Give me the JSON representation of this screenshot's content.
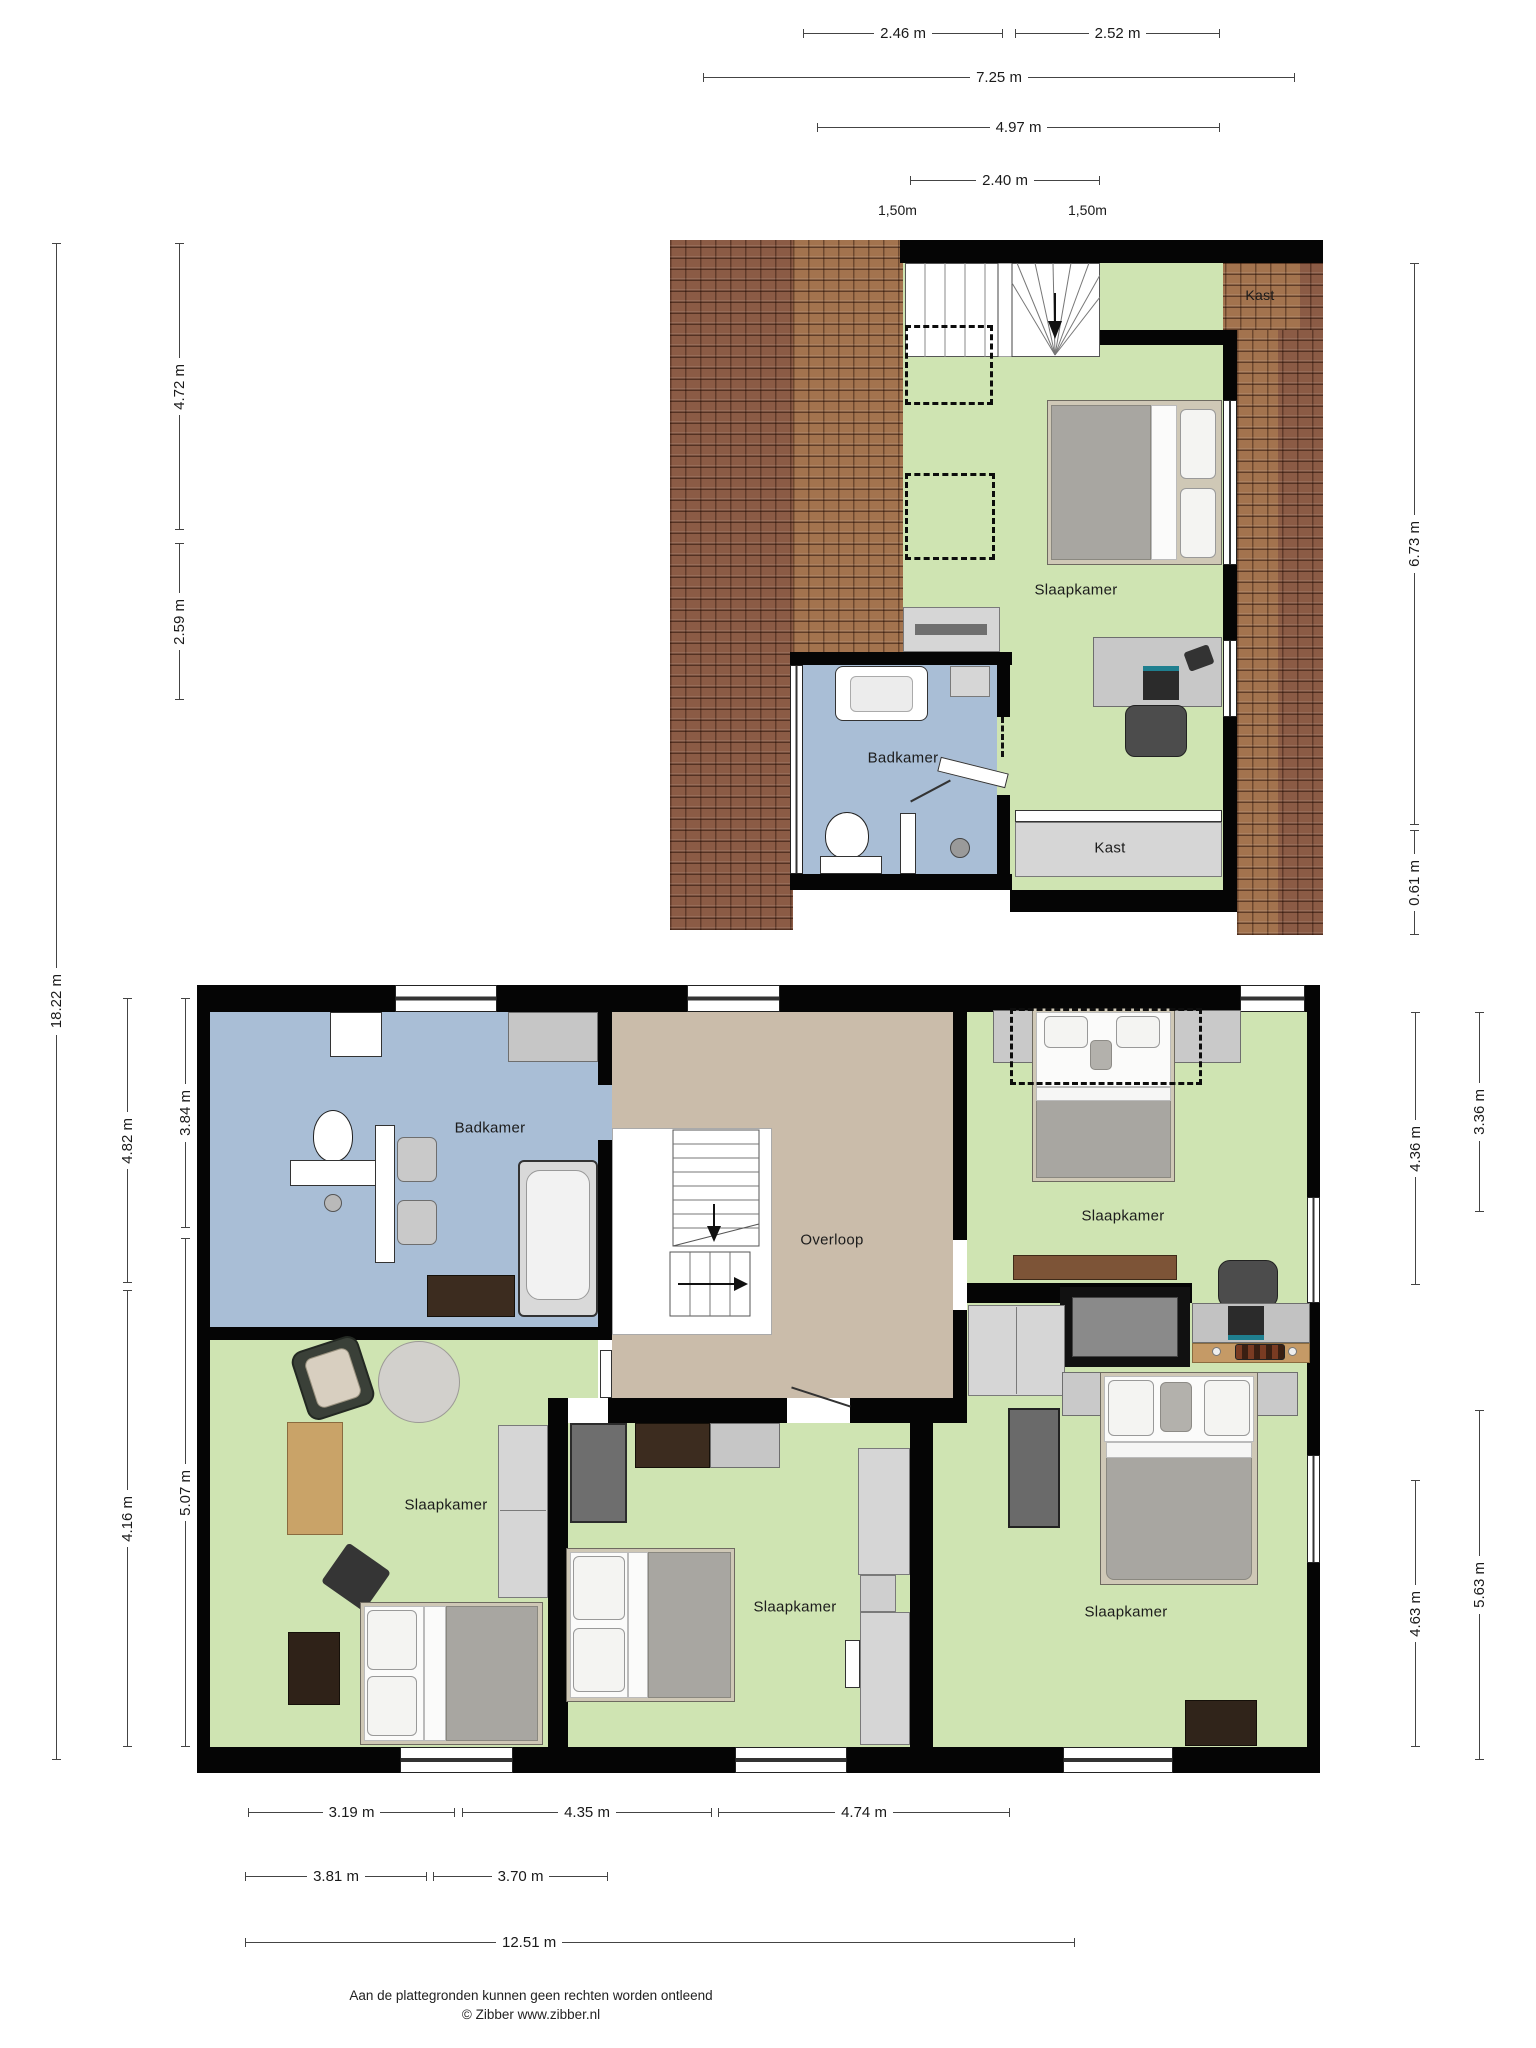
{
  "dims": {
    "w246": "2.46 m",
    "w252": "2.52 m",
    "w725": "7.25 m",
    "w497": "4.97 m",
    "w240": "2.40 m",
    "w150a": "1,50m",
    "w150b": "1,50m",
    "h472": "4.72 m",
    "h259": "2.59 m",
    "h1822": "18.22 m",
    "h673": "6.73 m",
    "h061": "0.61 m",
    "h482": "4.82 m",
    "h384": "3.84 m",
    "h416": "4.16 m",
    "h507": "5.07 m",
    "h436": "4.36 m",
    "h336": "3.36 m",
    "h463": "4.63 m",
    "h563": "5.63 m",
    "b319": "3.19 m",
    "b435": "4.35 m",
    "b474": "4.74 m",
    "b381": "3.81 m",
    "b370": "3.70 m",
    "b1251": "12.51 m"
  },
  "rooms": {
    "attic_slaapkamer": "Slaapkamer",
    "attic_badkamer": "Badkamer",
    "attic_kast_roof": "Kast",
    "attic_kast_closet": "Kast",
    "ff_badkamer": "Badkamer",
    "ff_overloop": "Overloop",
    "ff_slaapkamer_tr": "Slaapkamer",
    "ff_slaapkamer_bl": "Slaapkamer",
    "ff_slaapkamer_mid": "Slaapkamer",
    "ff_slaapkamer_br": "Slaapkamer"
  },
  "footer": {
    "disclaimer": "Aan de plattegronden kunnen geen rechten worden ontleend",
    "credit": "© Zibber www.zibber.nl"
  },
  "colors": {
    "room_green": "#cfe4b2",
    "room_blue": "#a9bed6",
    "hall_tan": "#cabcaa",
    "roof_brown": "#8b5b45",
    "wall": "#050505"
  }
}
